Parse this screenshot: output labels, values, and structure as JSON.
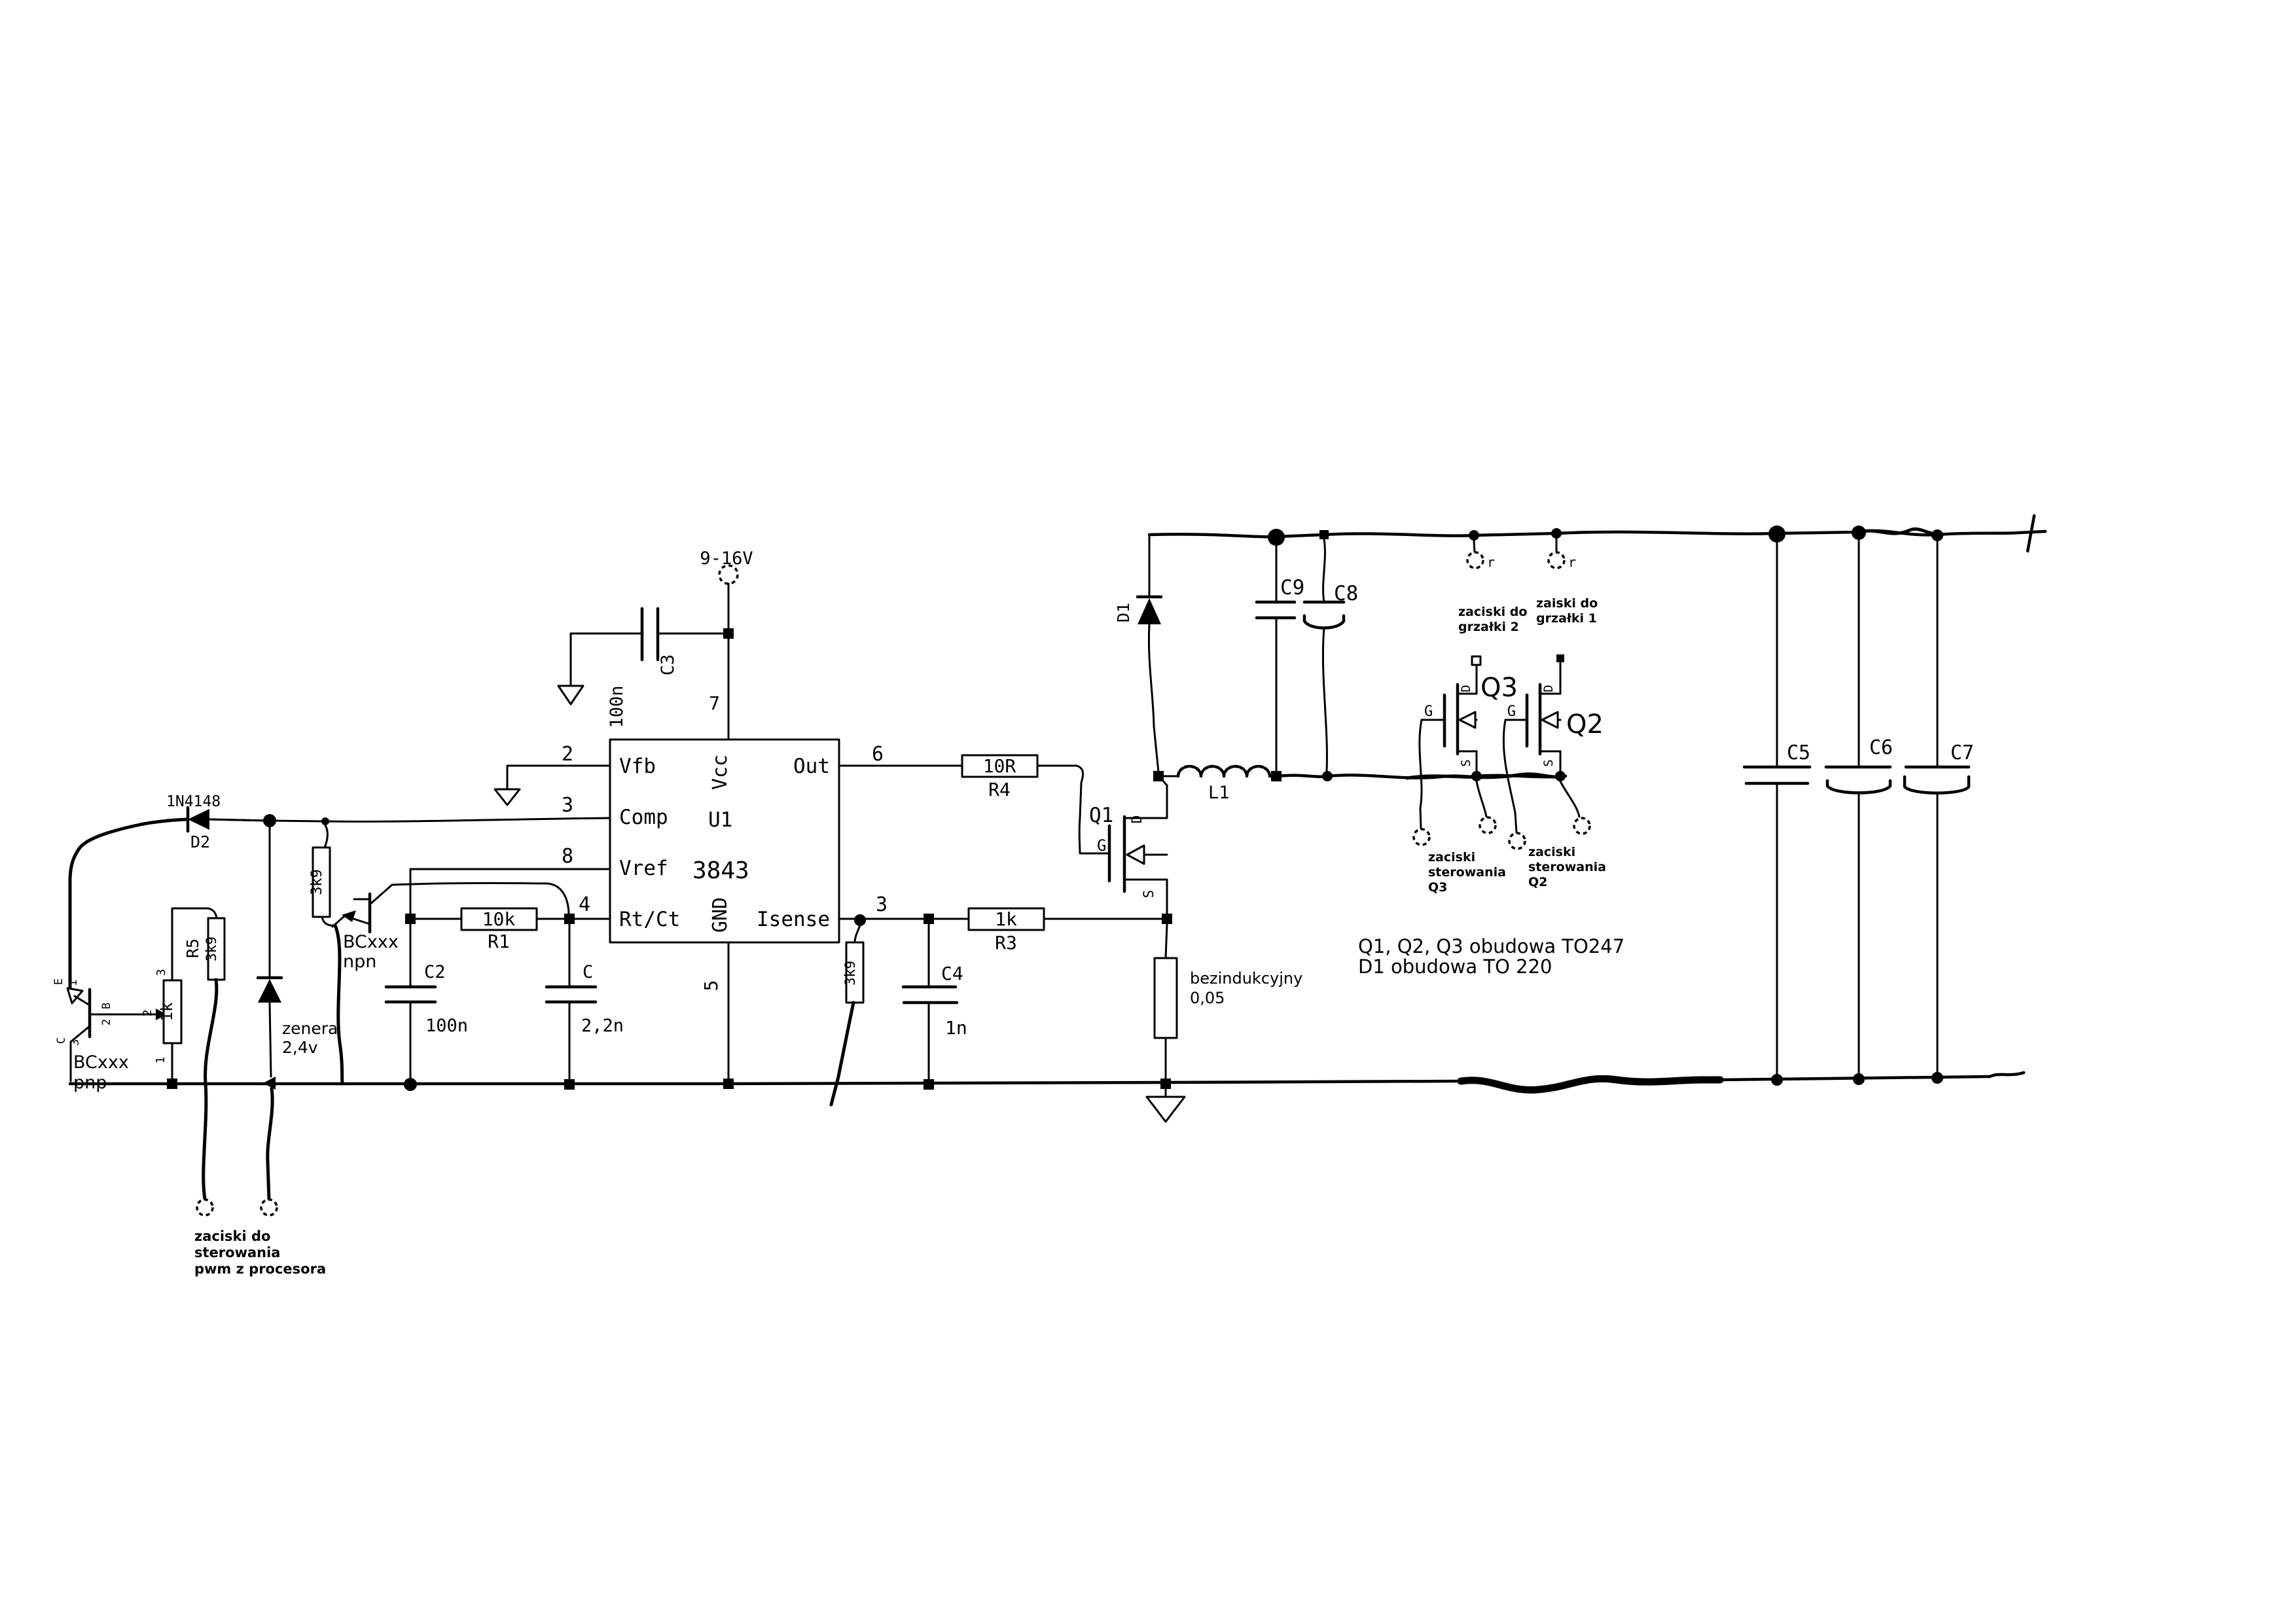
{
  "colors": {
    "ink": "#000000",
    "paper": "#ffffff"
  },
  "power": {
    "label": "9-16V"
  },
  "ic": {
    "ref": "U1",
    "part": "3843",
    "pin_vfb": "Vfb",
    "pin_comp": "Comp",
    "pin_vref": "Vref",
    "pin_rtct": "Rt/Ct",
    "pin_vcc": "Vcc",
    "pin_gnd": "GND",
    "pin_out": "Out",
    "pin_isense": "Isense",
    "num_p2": "2",
    "num_p3": "3",
    "num_p8": "8",
    "num_p4": "4",
    "num_p7": "7",
    "num_p5": "5",
    "num_p6": "6",
    "num_p3_right": "3"
  },
  "components": {
    "c3": {
      "ref": "C3",
      "value": "100n"
    },
    "d2": {
      "ref": "D2",
      "part": "1N4148"
    },
    "r_comp": {
      "value": "3k9"
    },
    "npn": {
      "line1": "BCxxx",
      "line2": "npn"
    },
    "r1": {
      "ref": "R1",
      "value": "10k"
    },
    "c2": {
      "ref": "C2",
      "value": "100n"
    },
    "c_ct": {
      "ref": "C",
      "value": "2,2n"
    },
    "r5": {
      "ref": "R5",
      "value": "3k9"
    },
    "pot": {
      "value": "1k",
      "pin1": "1",
      "pin2": "2",
      "pin3": "3"
    },
    "pnp": {
      "e": "E",
      "e_num": "1",
      "b": "B",
      "b_num": "2",
      "c": "C",
      "c_num": "3",
      "line1": "BCxxx",
      "line2": "pnp"
    },
    "zener": {
      "line1": "zenera",
      "line2": "2,4v"
    },
    "r4": {
      "ref": "R4",
      "value": "10R"
    },
    "r3": {
      "ref": "R3",
      "value": "1k"
    },
    "r_isense": {
      "value": "3k9"
    },
    "c4": {
      "ref": "C4",
      "value": "1n"
    },
    "q1": {
      "ref": "Q1",
      "d": "D",
      "g": "G",
      "s": "S"
    },
    "shunt": {
      "line1": "bezindukcyjny",
      "line2": "0,05"
    },
    "d1": {
      "ref": "D1"
    },
    "l1": {
      "ref": "L1"
    },
    "c9": {
      "ref": "C9"
    },
    "c8": {
      "ref": "C8"
    },
    "q3": {
      "ref": "Q3",
      "d": "D",
      "g": "G",
      "s": "S"
    },
    "q2": {
      "ref": "Q2",
      "d": "D",
      "g": "G",
      "s": "S"
    },
    "c5": {
      "ref": "C5"
    },
    "c6": {
      "ref": "C6"
    },
    "c7": {
      "ref": "C7"
    }
  },
  "annotations": {
    "pwm": [
      "zaciski do",
      "sterowania",
      "pwm z procesora"
    ],
    "heater2": [
      "zaciski do",
      "grzałki 2"
    ],
    "heater1": [
      "zaiski do",
      "grzałki 1"
    ],
    "ctrl_q3": [
      "zaciski",
      "sterowania",
      "Q3"
    ],
    "ctrl_q2": [
      "zaciski",
      "sterowania",
      "Q2"
    ],
    "note": [
      "Q1, Q2, Q3  obudowa TO247",
      "D1 obudowa TO 220"
    ],
    "term_mark1": "r",
    "term_mark2": "r"
  }
}
